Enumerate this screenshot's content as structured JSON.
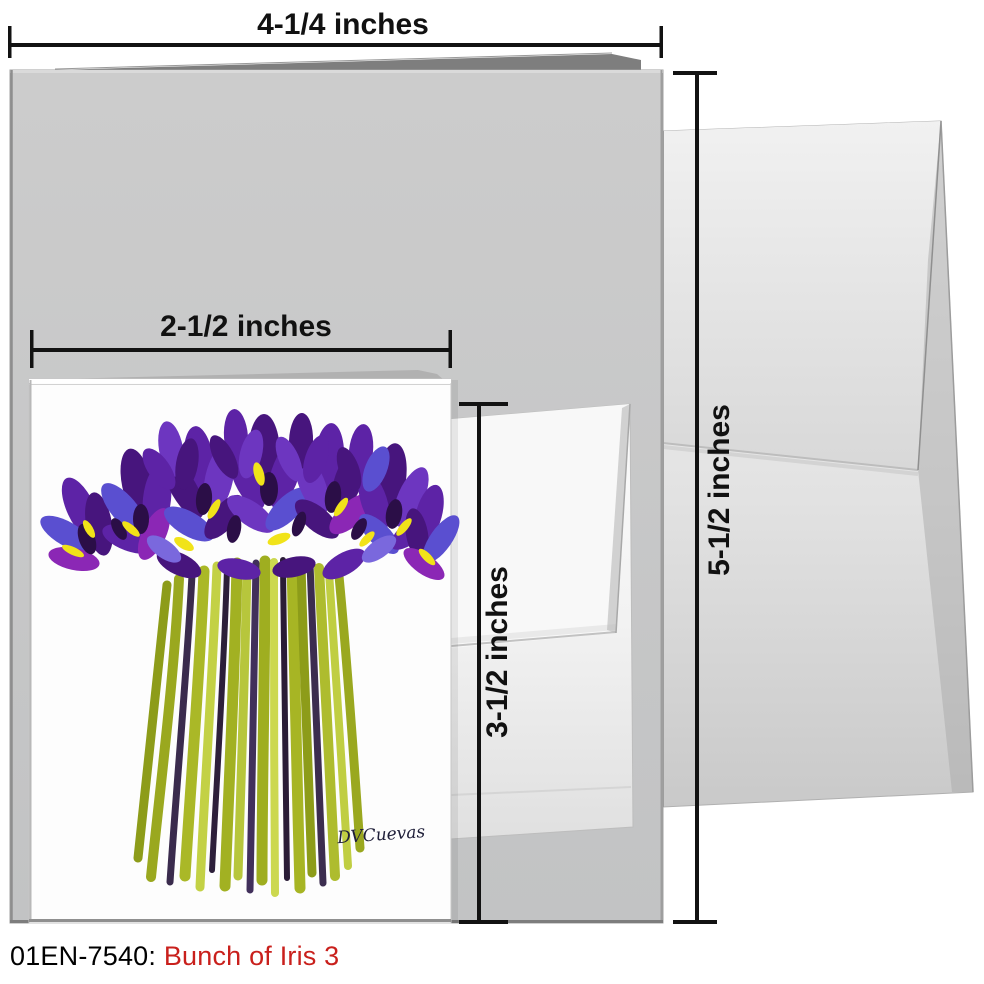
{
  "product": {
    "caption_code": "01EN-7540:",
    "caption_title": "Bunch of Iris 3"
  },
  "dimensions": {
    "card_width_label": "4-1/4 inches",
    "card_height_label": "5-1/2 inches",
    "inner_card_width_label": "2-1/2 inches",
    "inner_card_height_label": "3-1/2 inches"
  },
  "artwork": {
    "signature": "DVCuevas",
    "subject": "bunch of purple irises painting",
    "iris_purple": "#5d23a6",
    "iris_deep_purple": "#47157d",
    "iris_blue_violet": "#5a4fd0",
    "accent_yellow": "#f1e319",
    "stem_green": "#a3b224"
  },
  "colors": {
    "card_gray": "#c8c8c8",
    "envelope_white": "#f6f6f6",
    "dimension_line": "#121212",
    "caption_code_color": "#000000",
    "caption_title_color": "#c9201c"
  }
}
